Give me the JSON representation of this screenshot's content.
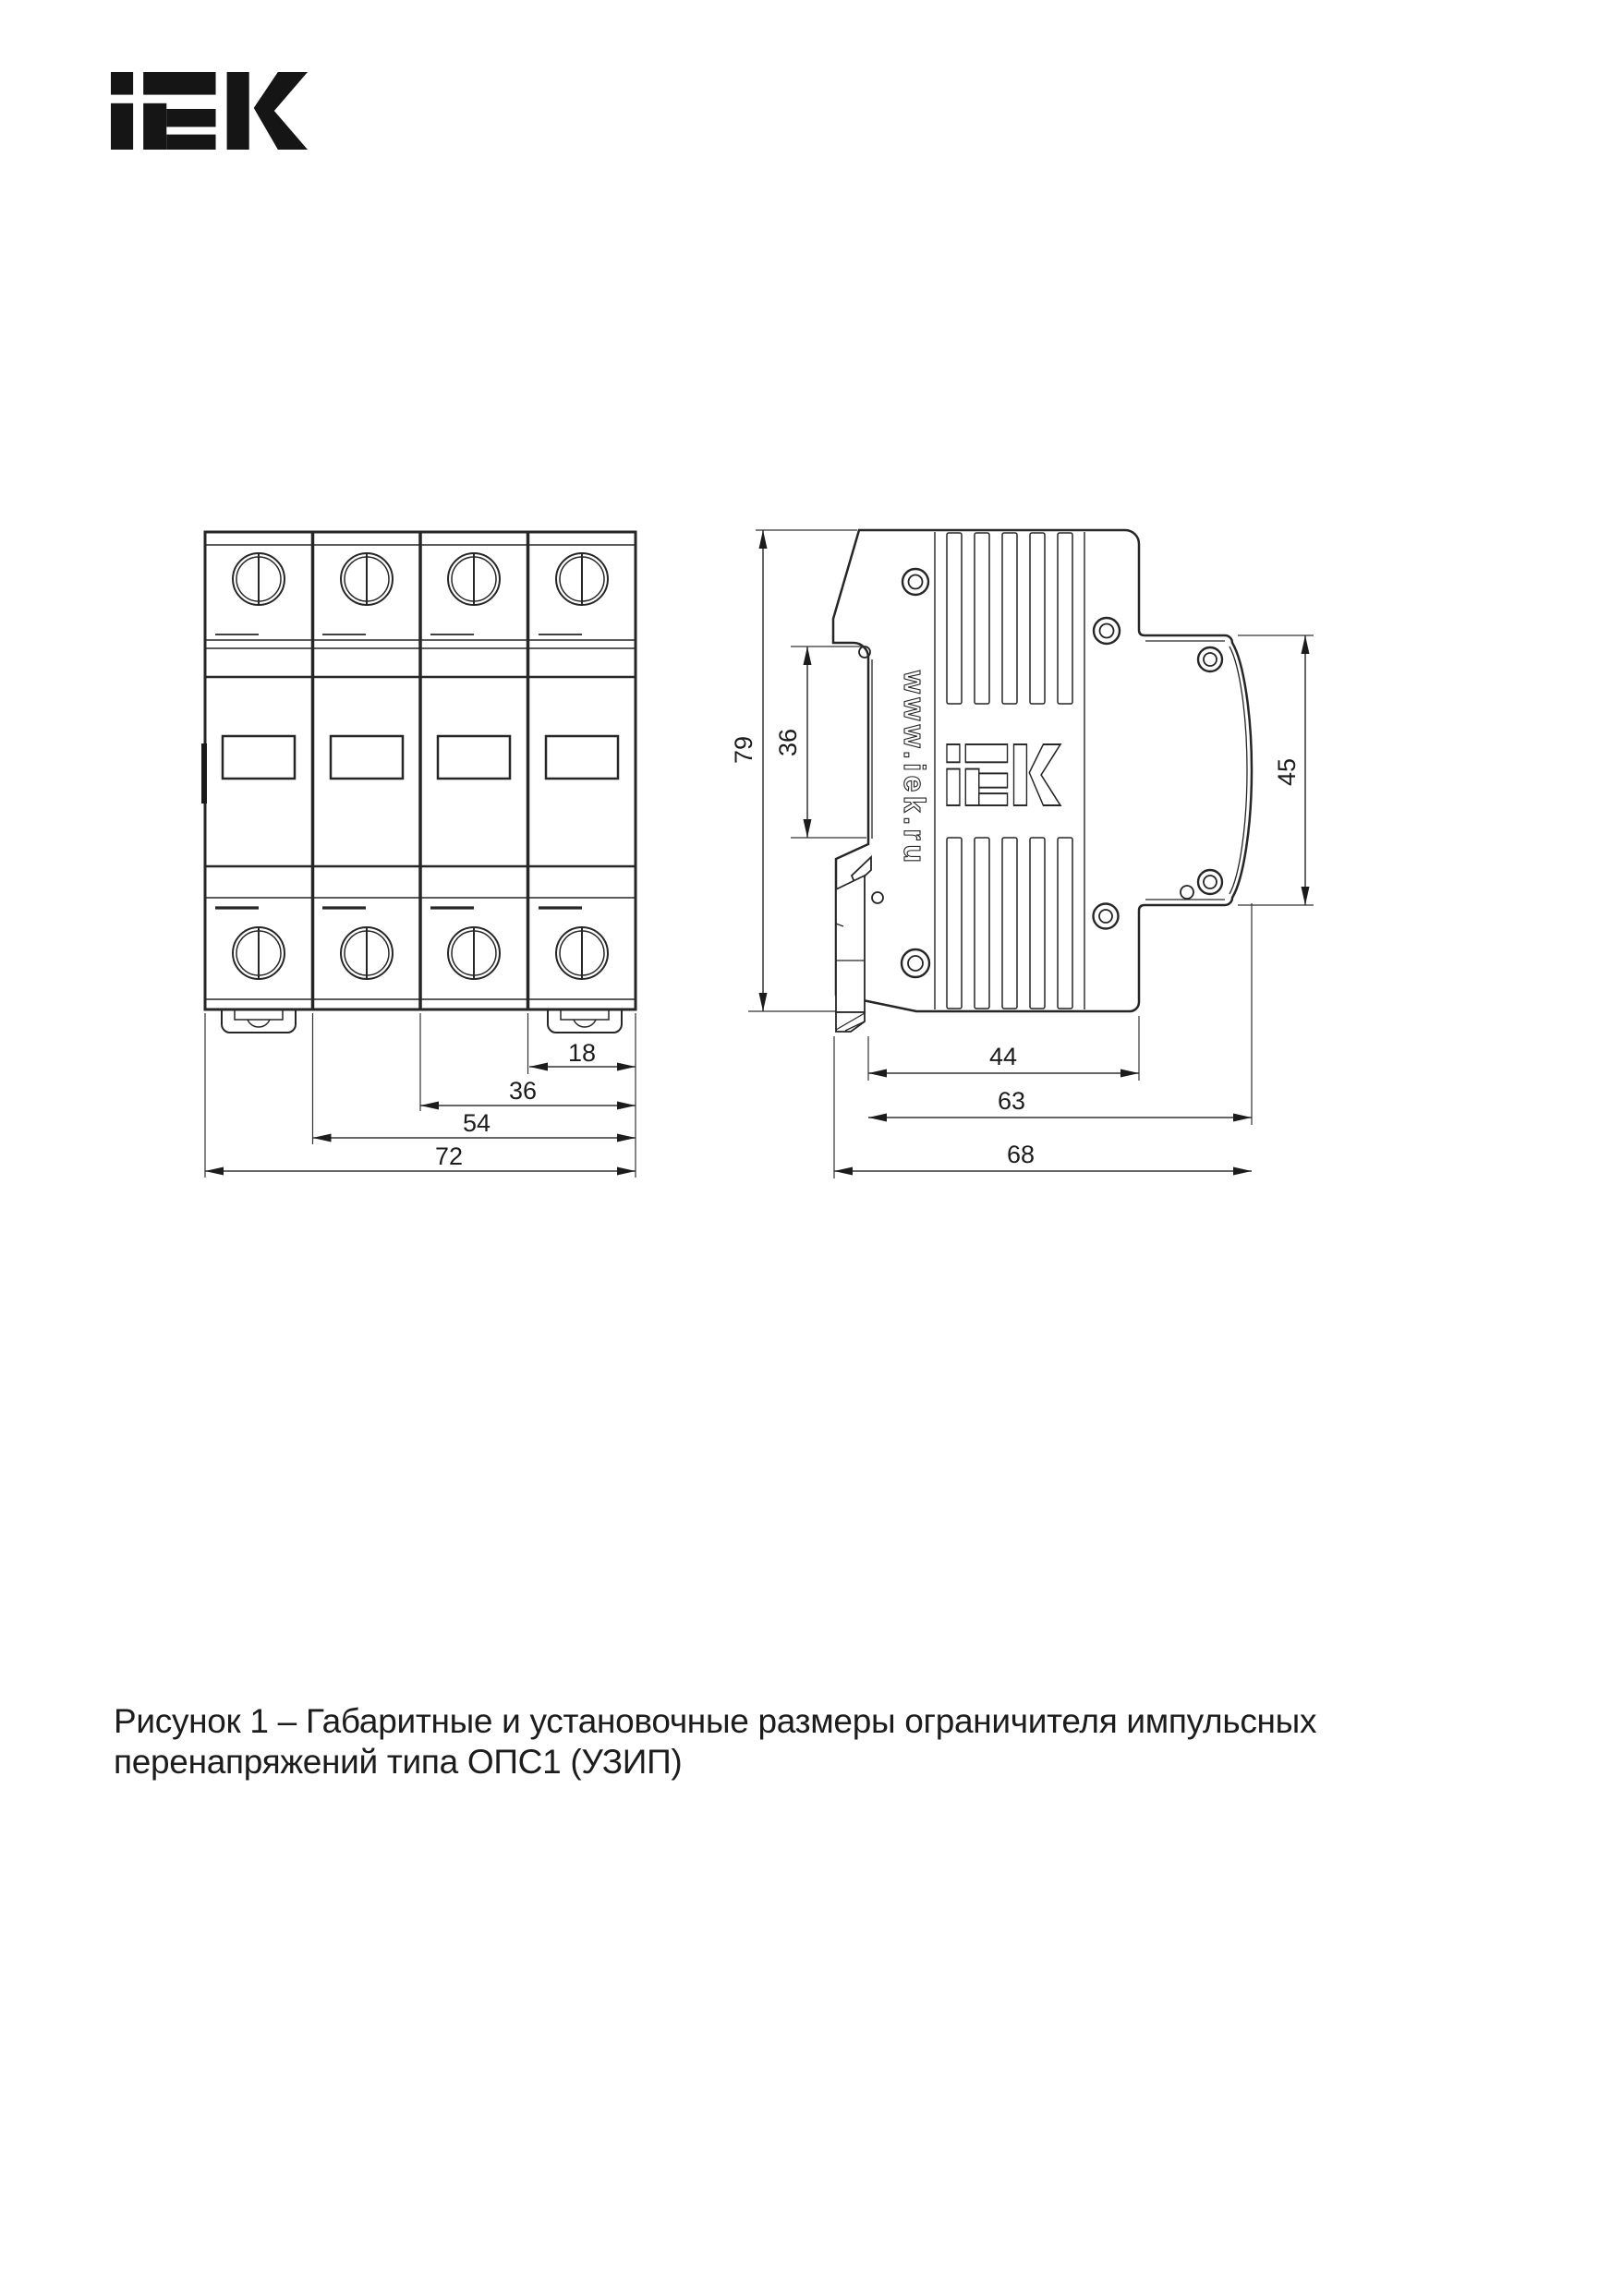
{
  "brand": {
    "logo_text": "iEK"
  },
  "figure": {
    "front_view": {
      "dim_module": "18",
      "dim_two_modules": "36",
      "dim_three_modules": "54",
      "dim_total_width": "72"
    },
    "side_view": {
      "dim_height": "79",
      "dim_din_seat": "36",
      "dim_front_flange": "45",
      "dim_body_depth": "44",
      "dim_depth_with_flange": "63",
      "dim_total_depth": "68",
      "marking_website": "www.iek.ru"
    },
    "caption_line1": "Рисунок 1 – Габаритные и установочные размеры ограничителя импульсных",
    "caption_line2": "перенапряжений типа ОПС1 (УЗИП)"
  }
}
